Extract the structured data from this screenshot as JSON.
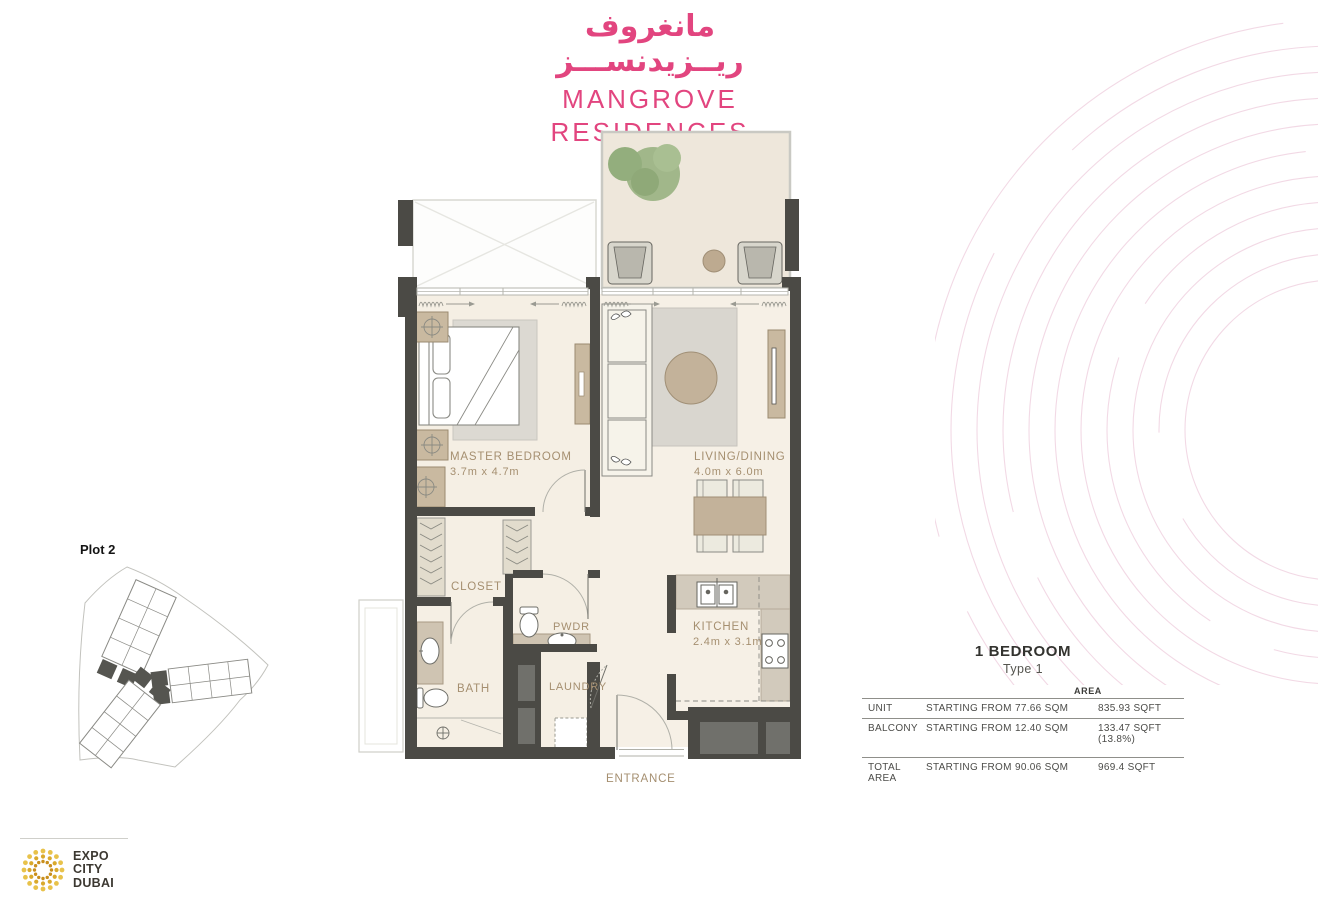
{
  "brand": {
    "arabic_line1": "مانغروف",
    "arabic_line2": "ريــزيدنســـز",
    "name_line1": "MANGROVE",
    "name_line2": "RESIDENCES",
    "accent_color": "#e2457f"
  },
  "site_plan": {
    "label": "Plot 2"
  },
  "floor_plan": {
    "label_color": "#a58f70",
    "wall_color": "#4b4a45",
    "rooms": {
      "master_bedroom": {
        "name": "MASTER BEDROOM",
        "dims": "3.7m x 4.7m"
      },
      "living_dining": {
        "name": "LIVING/DINING",
        "dims": "4.0m x 6.0m"
      },
      "kitchen": {
        "name": "KITCHEN",
        "dims": "2.4m x 3.1m"
      },
      "closet": {
        "name": "CLOSET"
      },
      "pwdr": {
        "name": "PWDR"
      },
      "bath": {
        "name": "BATH"
      },
      "laundry": {
        "name": "LAUNDRY"
      },
      "entrance": {
        "name": "ENTRANCE"
      }
    }
  },
  "unit_info": {
    "title": "1 BEDROOM",
    "subtitle": "Type 1",
    "area_header": "AREA",
    "rows": [
      {
        "label": "UNIT",
        "qualifier": "STARTING FROM",
        "sqm": "77.66 SQM",
        "sqft": "835.93 SQFT"
      },
      {
        "label": "BALCONY",
        "qualifier": "STARTING FROM",
        "sqm": "12.40 SQM",
        "sqft": "133.47 SQFT (13.8%)"
      },
      {
        "label": "TOTAL AREA",
        "qualifier": "STARTING FROM",
        "sqm": "90.06 SQM",
        "sqft": "969.4 SQFT"
      }
    ]
  },
  "footer_logo": {
    "line1": "EXPO",
    "line2": "CITY",
    "line3": "DUBAI"
  }
}
